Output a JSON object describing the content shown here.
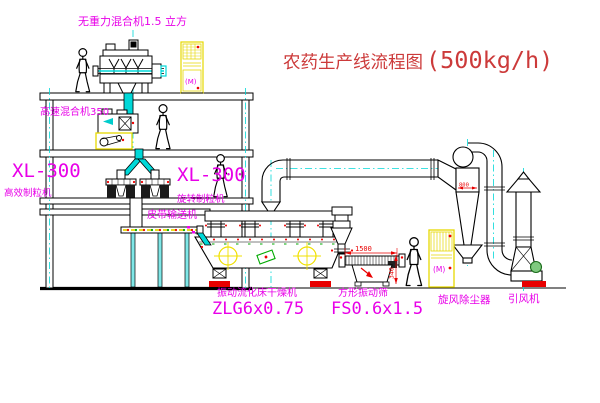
{
  "title": {
    "name": "农药生产线流程图",
    "capacity": "(500kg/h)"
  },
  "equipment_labels": {
    "gravity_mixer": "无重力混合机1.5 立方",
    "high_speed_mixer": "高速混合机350",
    "granulator_left_model": "XL-300",
    "granulator_left_name": "高效制粒机",
    "granulator_right_model": "XL-300",
    "granulator_right_name": "旋转制粒机",
    "belt_conveyor": "皮带输送机",
    "fluid_bed_dryer_name": "振动流化床干燥机",
    "fluid_bed_dryer_model": "ZLG6x0.75",
    "vibrating_sieve_name": "方形振动筛",
    "vibrating_sieve_model": "FS0.6x1.5",
    "cyclone": "旋风除尘器",
    "induced_draft_fan": "引风机"
  },
  "dimensions": {
    "sieve_length": "1500",
    "sieve_outlet_height": "340",
    "cyclone_diameter": "800"
  },
  "annotations": {
    "motor_mark": "(M)"
  },
  "colors": {
    "background": "#ffffff",
    "line_black": "#000000",
    "label_magenta": "#e800e8",
    "title_red": "#cc3a3a",
    "centerline_cyan": "#00d8d8",
    "equipment_yellow": "#e6d800",
    "dimension_red": "#e80000",
    "green_accent": "#00aa00"
  }
}
